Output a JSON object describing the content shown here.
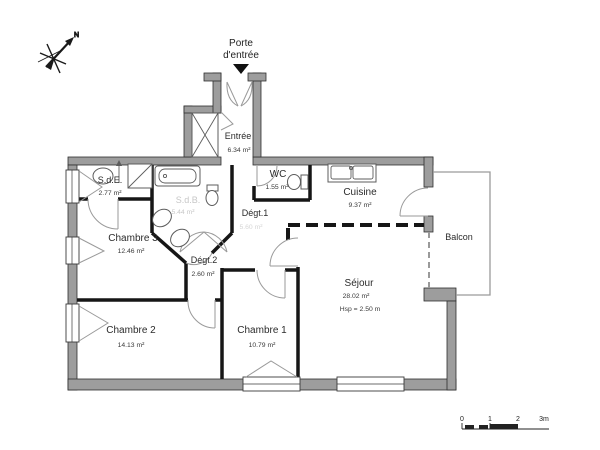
{
  "annotations": {
    "entrance_line1": "Porte",
    "entrance_line2": "d'entrée",
    "compass_north": "N"
  },
  "rooms": {
    "entree": {
      "name": "Entrée",
      "area": "6.34 m²"
    },
    "wc": {
      "name": "WC",
      "area": "1.55 m²"
    },
    "cuisine": {
      "name": "Cuisine",
      "area": "9.37 m²"
    },
    "sde": {
      "name": "S.d.E.",
      "area": "2.77 m²"
    },
    "sdb": {
      "name": "S.d.B.",
      "area": "5.44 m²"
    },
    "degt1": {
      "name": "Dégt.1",
      "area": "5.60 m²"
    },
    "degt2": {
      "name": "Dégt.2",
      "area": "2.60 m²"
    },
    "chambre3": {
      "name": "Chambre 3",
      "area": "12.46 m²"
    },
    "chambre2": {
      "name": "Chambre 2",
      "area": "14.13 m²"
    },
    "chambre1": {
      "name": "Chambre 1",
      "area": "10.79 m²"
    },
    "sejour": {
      "name": "Séjour",
      "area": "28.02 m²",
      "ceiling_height": "Hsp = 2.50 m"
    },
    "balcon": {
      "name": "Balcon"
    }
  },
  "scale_bar": {
    "tick0": "0",
    "tick1": "1",
    "tick2": "2",
    "tick3": "3m"
  },
  "colors": {
    "wall_fill": "#9d9d9d",
    "wall_edge": "#2f2f2f",
    "interior_wall": "#161616",
    "faint_label": "#c7c7c7",
    "door_arc": "#9a9a9a",
    "text": "#2b2b2b"
  }
}
